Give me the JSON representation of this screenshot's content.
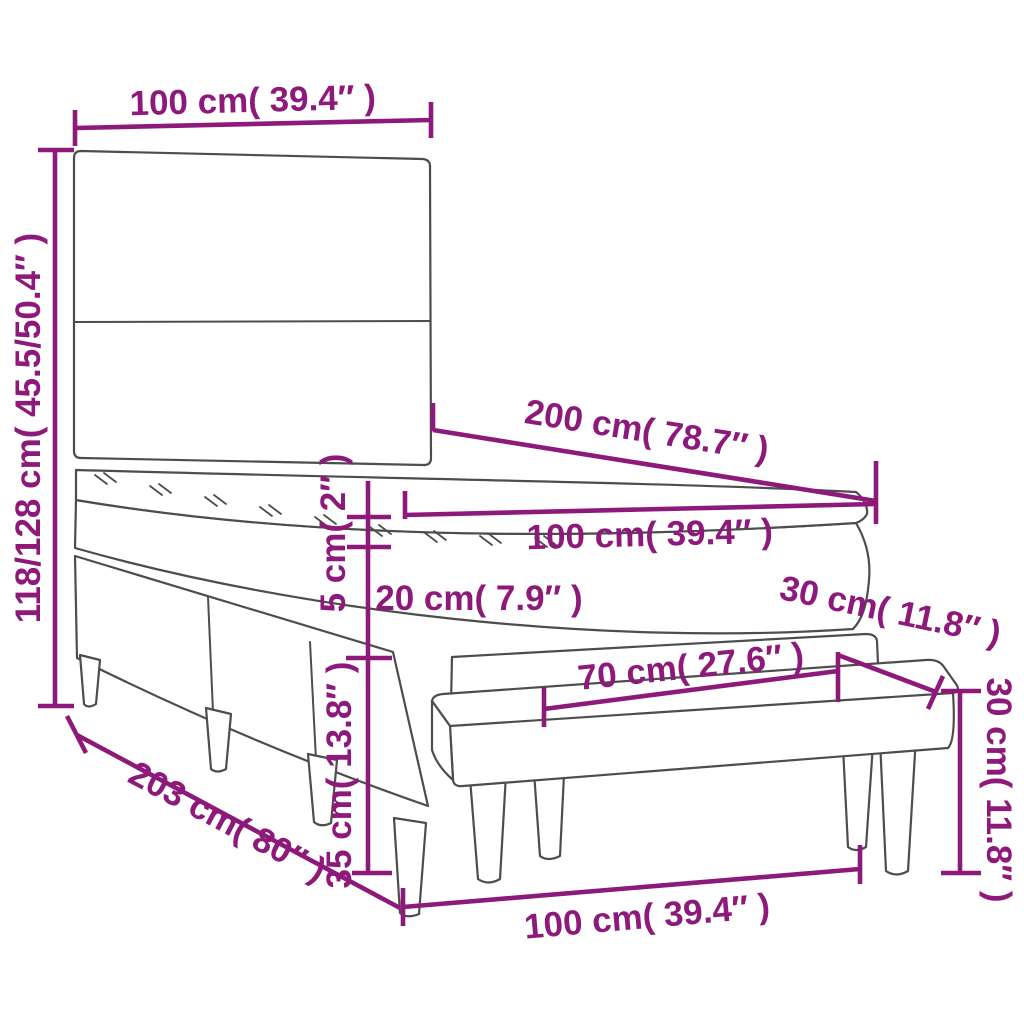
{
  "diagram": {
    "type": "furniture-dimension-diagram",
    "subject": "box-spring-bed-with-headboard-topper-and-bench",
    "colors": {
      "dimension_accent": "#8d1a7b",
      "outline": "#4d4d4d",
      "background": "#ffffff"
    },
    "dimensions": {
      "headboard_width": {
        "label": "100 cm( 39.4″  )"
      },
      "total_height": {
        "label": "118/128 cm( 45.5/50.4″  )"
      },
      "bed_length": {
        "label": "200 cm( 78.7″  )"
      },
      "mattress_width": {
        "label": "100 cm( 39.4″  )"
      },
      "topper_thickness": {
        "label": "5 cm( 2″  )"
      },
      "mattress_thickness": {
        "label": "20 cm( 7.9″  )"
      },
      "base_height": {
        "label": "35 cm( 13.8″  )"
      },
      "base_length": {
        "label": "203 cm( 80″  )"
      },
      "bench_depth": {
        "label": "30 cm( 11.8″  )"
      },
      "bench_height": {
        "label": "30 cm( 11.8″  )"
      },
      "bench_leg_span": {
        "label": "70 cm( 27.6″  )"
      },
      "bench_length": {
        "label": "100 cm( 39.4″  )"
      }
    }
  }
}
